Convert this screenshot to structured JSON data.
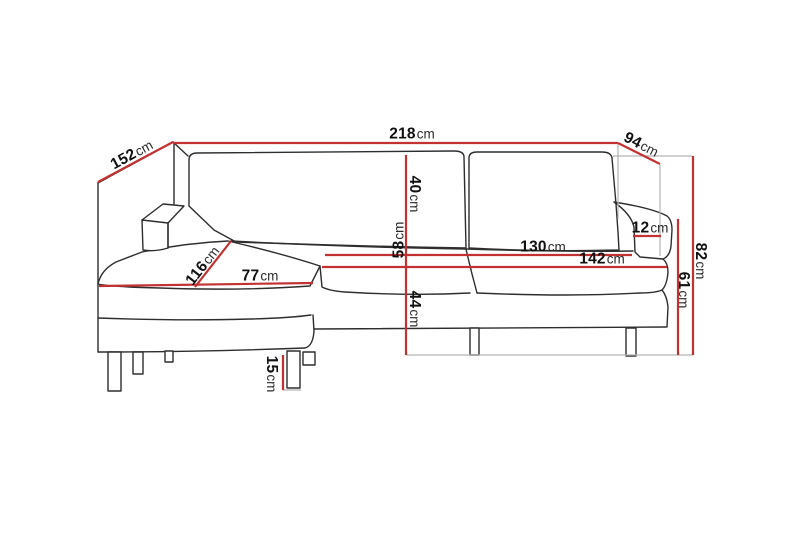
{
  "diagram": {
    "type": "furniture-dimension-drawing",
    "subject": "corner sofa with chaise longue, perspective line drawing",
    "unit": "cm",
    "colors": {
      "background": "#ffffff",
      "outline": "#2e2e2e",
      "dimension_red": "#c23232",
      "guide_gray": "#b3b3b3",
      "label_text": "#111111"
    },
    "dimensions": [
      {
        "id": "chaise-side-depth",
        "value": "152",
        "unit": "cm"
      },
      {
        "id": "total-width",
        "value": "218",
        "unit": "cm"
      },
      {
        "id": "right-side-depth",
        "value": "94",
        "unit": "cm"
      },
      {
        "id": "total-height",
        "value": "82",
        "unit": "cm"
      },
      {
        "id": "armrest-height",
        "value": "61",
        "unit": "cm"
      },
      {
        "id": "armrest-width",
        "value": "12",
        "unit": "cm"
      },
      {
        "id": "backrest-cushion-height",
        "value": "40",
        "unit": "cm"
      },
      {
        "id": "back-seat-height",
        "value": "58",
        "unit": "cm"
      },
      {
        "id": "seat-height",
        "value": "44",
        "unit": "cm"
      },
      {
        "id": "inner-seat-width",
        "value": "130",
        "unit": "cm"
      },
      {
        "id": "seat-width",
        "value": "142",
        "unit": "cm"
      },
      {
        "id": "chaise-length",
        "value": "116",
        "unit": "cm"
      },
      {
        "id": "chaise-seat-width",
        "value": "77",
        "unit": "cm"
      },
      {
        "id": "leg-height",
        "value": "15",
        "unit": "cm"
      }
    ]
  }
}
